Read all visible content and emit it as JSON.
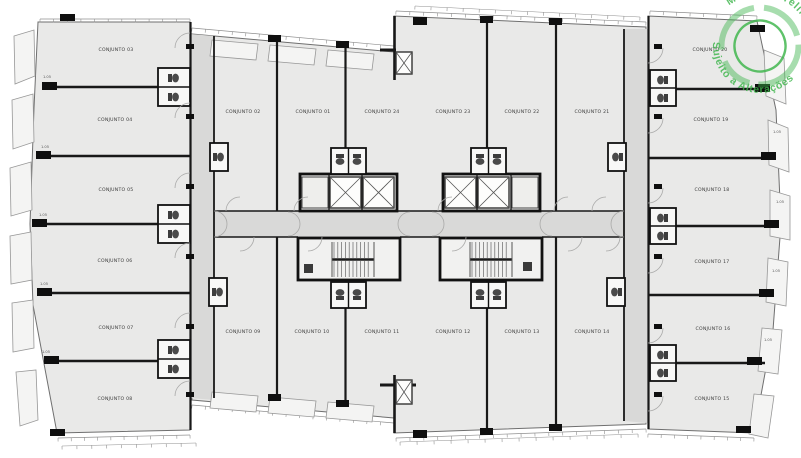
{
  "document": {
    "type": "architectural-floor-plan",
    "title": "Pavimento tipo - conjuntos"
  },
  "stamp": {
    "line_top": "Material Preliminar",
    "line_bottom": "Sujeito a Alterações",
    "color": "#3cb54a"
  },
  "colors": {
    "room_fill": "#e9e9e8",
    "corridor_fill": "#d9d9d8",
    "wall": "#181818",
    "window_line": "#8f8f8f",
    "background": "#ffffff"
  },
  "rooms": [
    {
      "label": "CONJUNTO 01",
      "x": 313,
      "y": 113
    },
    {
      "label": "CONJUNTO 02",
      "x": 243,
      "y": 113
    },
    {
      "label": "CONJUNTO 03",
      "x": 116,
      "y": 51
    },
    {
      "label": "CONJUNTO 04",
      "x": 115,
      "y": 121
    },
    {
      "label": "CONJUNTO 05",
      "x": 116,
      "y": 191
    },
    {
      "label": "CONJUNTO 06",
      "x": 115,
      "y": 262
    },
    {
      "label": "CONJUNTO 07",
      "x": 116,
      "y": 329
    },
    {
      "label": "CONJUNTO 08",
      "x": 115,
      "y": 400
    },
    {
      "label": "CONJUNTO 09",
      "x": 243,
      "y": 333
    },
    {
      "label": "CONJUNTO 10",
      "x": 312,
      "y": 333
    },
    {
      "label": "CONJUNTO 11",
      "x": 382,
      "y": 333
    },
    {
      "label": "CONJUNTO 12",
      "x": 453,
      "y": 333
    },
    {
      "label": "CONJUNTO 13",
      "x": 522,
      "y": 333
    },
    {
      "label": "CONJUNTO 14",
      "x": 592,
      "y": 333
    },
    {
      "label": "CONJUNTO 15",
      "x": 712,
      "y": 400
    },
    {
      "label": "CONJUNTO 16",
      "x": 713,
      "y": 330
    },
    {
      "label": "CONJUNTO 17",
      "x": 712,
      "y": 263
    },
    {
      "label": "CONJUNTO 18",
      "x": 712,
      "y": 191
    },
    {
      "label": "CONJUNTO 19",
      "x": 711,
      "y": 121
    },
    {
      "label": "CONJUNTO 20",
      "x": 710,
      "y": 51
    },
    {
      "label": "CONJUNTO 21",
      "x": 592,
      "y": 113
    },
    {
      "label": "CONJUNTO 22",
      "x": 522,
      "y": 113
    },
    {
      "label": "CONJUNTO 23",
      "x": 453,
      "y": 113
    },
    {
      "label": "CONJUNTO 24",
      "x": 382,
      "y": 113
    }
  ],
  "dimension_labels": [
    {
      "text": "1.05",
      "x": 47,
      "y": 78
    },
    {
      "text": "1.05",
      "x": 45,
      "y": 148
    },
    {
      "text": "1.05",
      "x": 43,
      "y": 216
    },
    {
      "text": "1.05",
      "x": 44,
      "y": 285
    },
    {
      "text": "1.05",
      "x": 46,
      "y": 353
    },
    {
      "text": "1.05",
      "x": 777,
      "y": 133
    },
    {
      "text": "1.05",
      "x": 780,
      "y": 203
    },
    {
      "text": "1.05",
      "x": 776,
      "y": 272
    },
    {
      "text": "1.05",
      "x": 768,
      "y": 341
    }
  ]
}
